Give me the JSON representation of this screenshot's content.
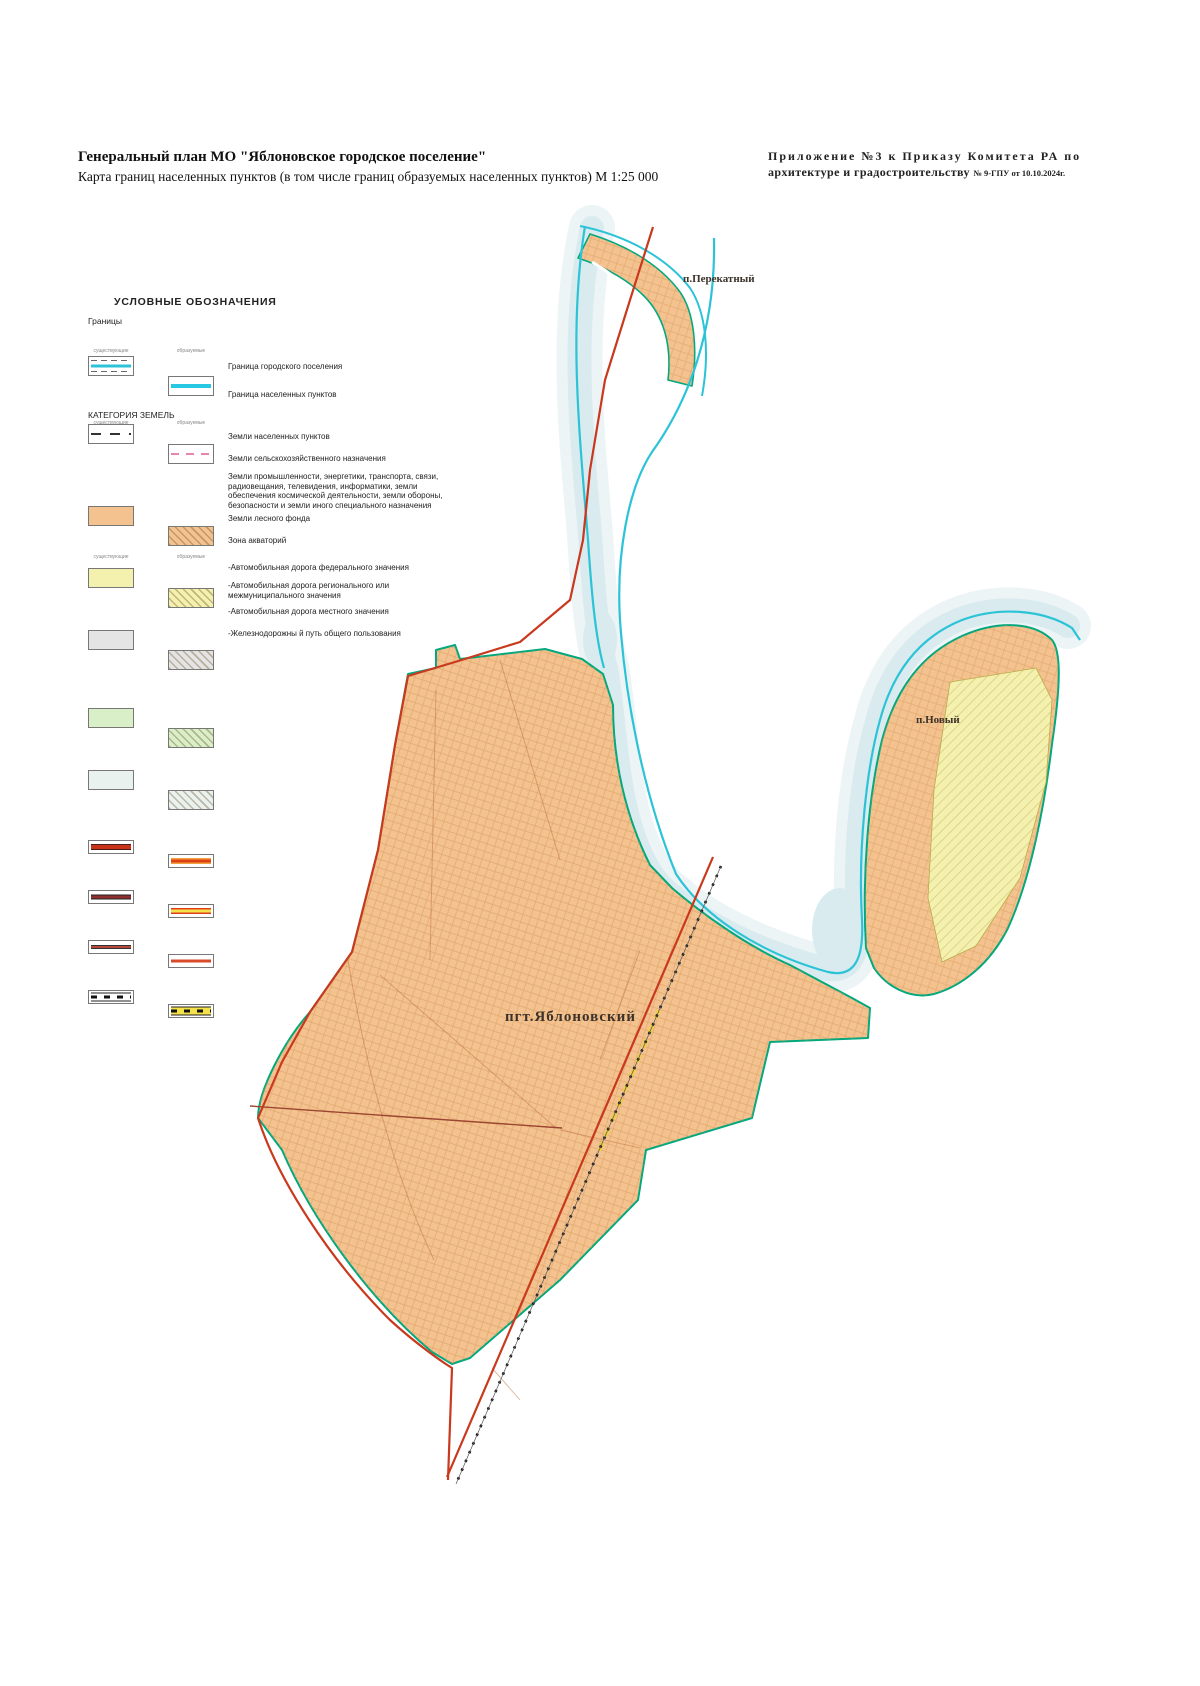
{
  "page": {
    "title": "Генеральный план МО \"Яблоновское городское поселение\"",
    "subtitle": "Карта границ населенных пунктов (в том числе границ образуемых населенных пунктов) М  1:25 000",
    "annex_line1": "Приложение №3 к Приказу Комитета РА по",
    "annex_line2": "архитектуре и градостроительству",
    "annex_ref": "№ 9-ГПУ от 10.10.2024г."
  },
  "legend": {
    "title": "УСЛОВНЫЕ ОБОЗНАЧЕНИЯ",
    "borders_section": "Границы",
    "col_existing": "существующие",
    "col_formed": "образуемые",
    "borders": [
      {
        "label": "Граница городского поселения"
      },
      {
        "label": "Граница населенных пунктов"
      }
    ],
    "categories_section": "КАТЕГОРИЯ ЗЕМЕЛЬ",
    "categories": [
      {
        "label": "Земли населенных пунктов",
        "color": "#f4c28f"
      },
      {
        "label": "Земли сельскохозяйственного назначения",
        "color": "#f4f0ae"
      },
      {
        "label": "Земли промышленности, энергетики, транспорта, связи, радиовещания, телевидения, информатики, земли обеспечения космической деятельности, земли обороны, безопасности и земли иного специального назначения",
        "color": "#e4e4e4"
      },
      {
        "label": "Земли лесного фонда",
        "color": "#d9efc7"
      },
      {
        "label": "Зона акваторий",
        "color": "#e9f2ef"
      }
    ],
    "roads": [
      {
        "label": "-Автомобильная дорога федерального значения"
      },
      {
        "label": "-Автомобильная дорога регионального или межмуниципального значения"
      },
      {
        "label": "-Автомобильная дорога местного значения"
      },
      {
        "label": "-Железнодорожны й путь общего пользования"
      }
    ]
  },
  "map": {
    "labels": {
      "perekatny": "п.Перекатный",
      "novy": "п.Новый",
      "yablonovsky": "пгт.Яблоновский"
    },
    "colors": {
      "settlement_fill": "#f4c28f",
      "agriculture_fill": "#f4f0ae",
      "water_fill": "#d9ebef",
      "town_boundary_cyan": "#2cc3d7",
      "settlement_boundary_teal": "#00a87e",
      "federal_road_red": "#c8391d",
      "railway_black": "#1a1a1a"
    }
  }
}
